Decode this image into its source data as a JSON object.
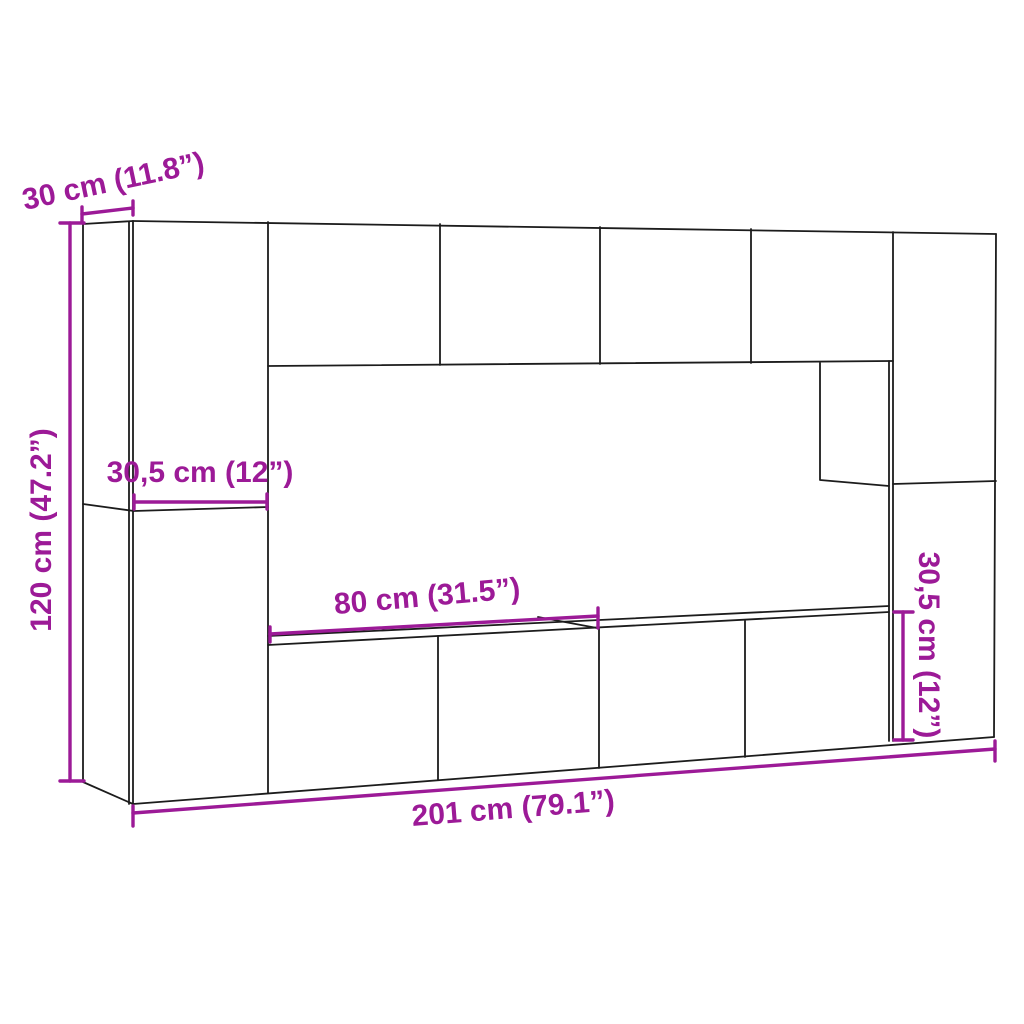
{
  "figure": {
    "background": "#ffffff",
    "line_color": "#1c1c1c",
    "dimension_color": "#9c1a97",
    "dimensions": {
      "panel_depth": {
        "label": "30 cm (11.8”)"
      },
      "unit_height": {
        "label": "120 cm (47.2”)"
      },
      "side_cabinet_width": {
        "label": "30,5 cm (12”)"
      },
      "tv_cabinet_width": {
        "label": "80 cm (31.5”)"
      },
      "tv_cabinet_height": {
        "label": "30,5 cm (12”)"
      },
      "total_width": {
        "label": "201 cm (79.1”)"
      }
    }
  }
}
